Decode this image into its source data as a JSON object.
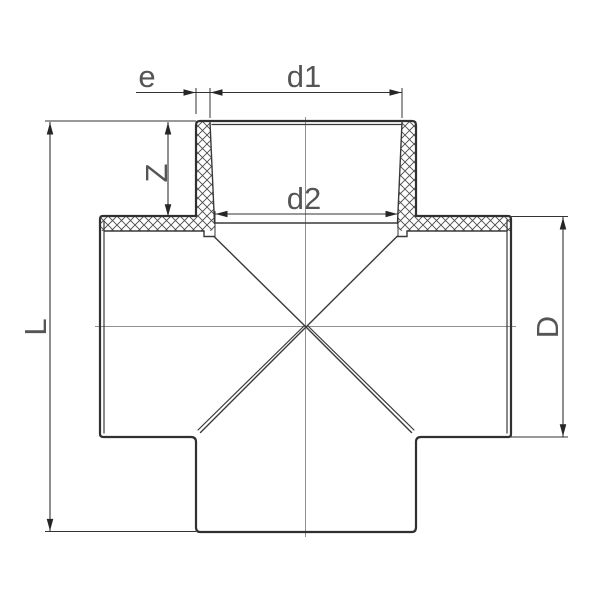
{
  "page": {
    "background": "#ffffff",
    "width": 600,
    "height": 600
  },
  "drawing": {
    "kind": "technical-dimension-drawing",
    "subject": "four-way cross pipe fitting, front view half-section with crosshatched socket walls",
    "labels": {
      "wall_thickness": "e",
      "socket_mouth_diameter": "d1",
      "socket_root_diameter": "d2",
      "socket_depth": "Z",
      "overall_length": "L",
      "outer_diameter": "D"
    },
    "colors": {
      "background": "#ffffff",
      "outline": "#303030",
      "section_lines": "#3a3a3a",
      "dimension_lines": "#333333",
      "arrowheads": "#262626",
      "centerlines": "#909090",
      "label_text": "#555555"
    }
  }
}
